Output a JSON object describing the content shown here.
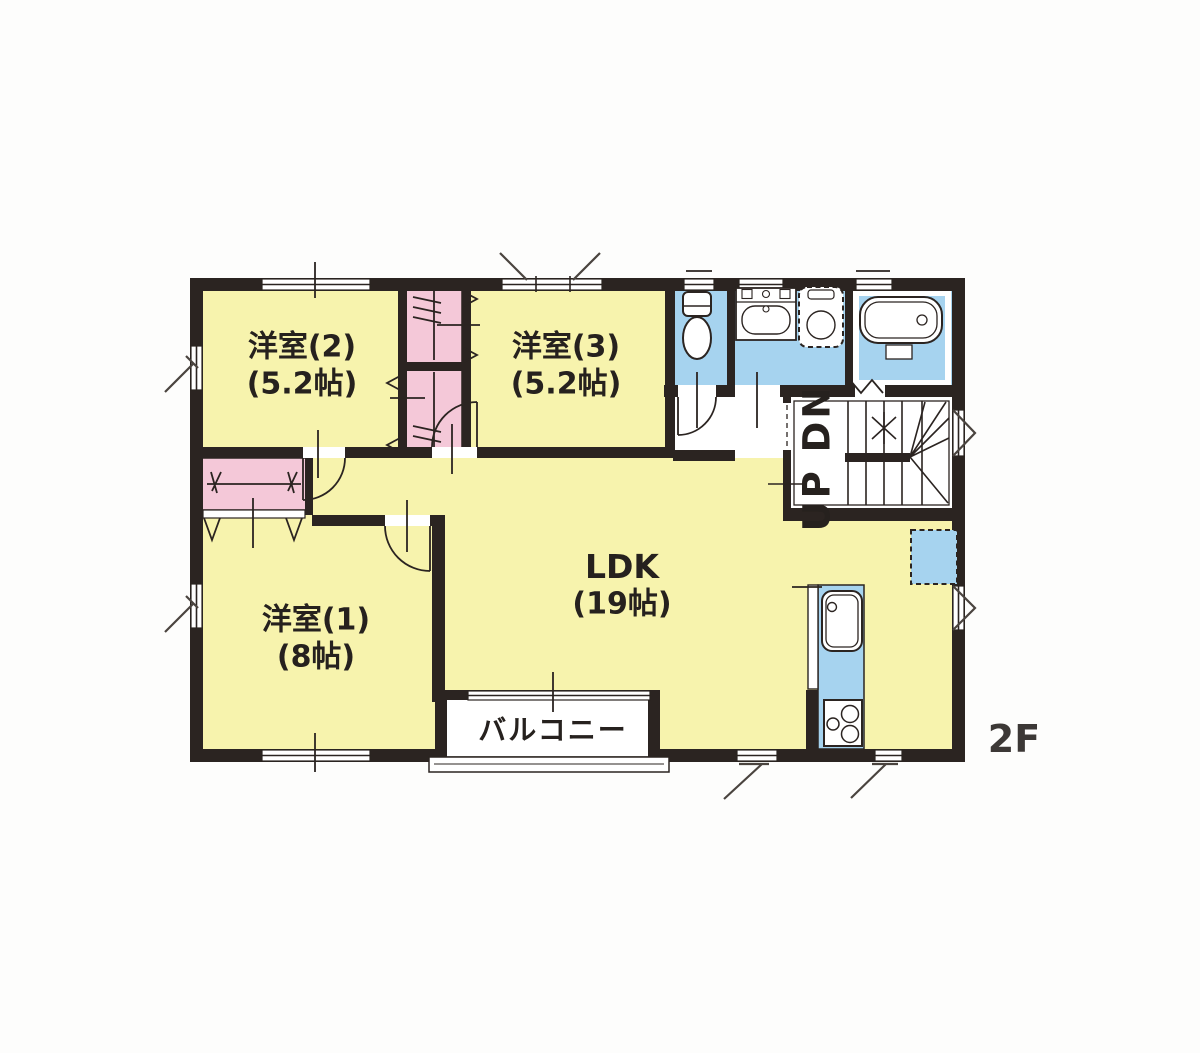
{
  "floor_label": "2F",
  "rooms": {
    "yoshitsu2": {
      "name": "洋室(2)",
      "size": "(5.2帖)"
    },
    "yoshitsu3": {
      "name": "洋室(3)",
      "size": "(5.2帖)"
    },
    "yoshitsu1": {
      "name": "洋室(1)",
      "size": "(8帖)"
    },
    "ldk": {
      "name": "LDK",
      "size": "(19帖)"
    },
    "balcony": {
      "name": "バルコニー"
    },
    "stairs": {
      "label": "UP DN"
    }
  },
  "fixtures": {
    "toilet": "toilet-icon",
    "vanity": "vanity-sink-icon",
    "washing_machine": "washing-machine-space-icon",
    "bathtub": "bathtub-icon",
    "kitchen_sink": "kitchen-sink-icon",
    "stove": "stove-icon",
    "refrigerator": "refrigerator-space-icon"
  },
  "colors": {
    "room_fill": "#f7f3ad",
    "closet_fill": "#f4c8d8",
    "wet_area_fill": "#a6d3ef",
    "wall": "#2b2421",
    "floor_label_color": "#3c3836"
  }
}
